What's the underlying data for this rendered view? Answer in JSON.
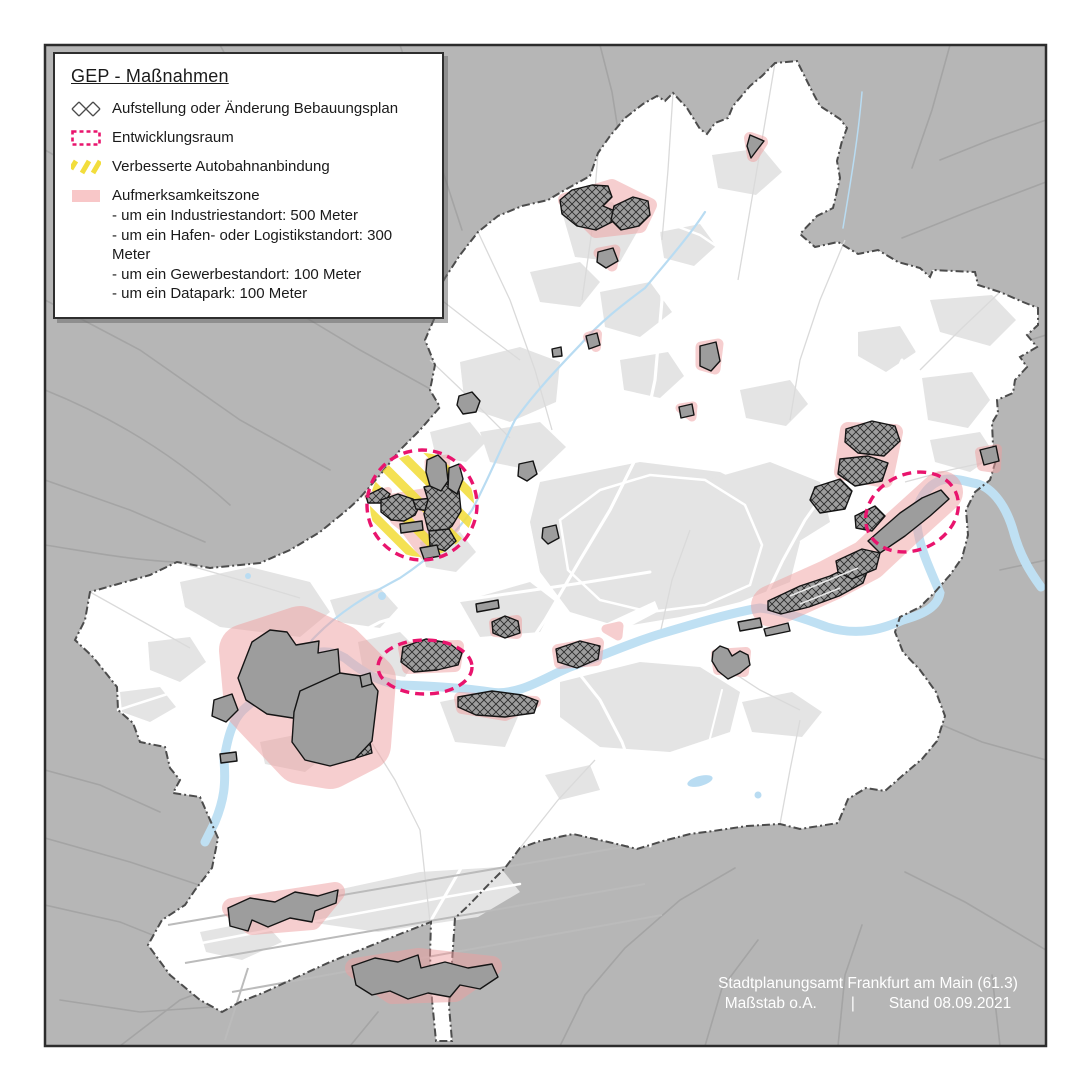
{
  "legend": {
    "title": "GEP - Maßnahmen",
    "items": [
      {
        "icon": "crosshatch-swatch",
        "label": "Aufstellung oder Änderung Bebauungsplan"
      },
      {
        "icon": "dashed-rect-swatch",
        "label": "Entwicklungsraum"
      },
      {
        "icon": "yellow-stripes-swatch",
        "label": "Verbesserte Autobahnanbindung"
      },
      {
        "icon": "pink-fill-swatch",
        "label": "Aufmerksamkeitszone",
        "sublines": [
          "- um ein Industriestandort: 500 Meter",
          "- um ein Hafen- oder Logistikstandort: 300 Meter",
          "- um ein Gewerbestandort: 100 Meter",
          "- um ein Datapark: 100 Meter"
        ]
      }
    ]
  },
  "attribution": {
    "line1": "Stadtplanungsamt Frankfurt am Main (61.3)",
    "scale_label": "Maßstab o.A.",
    "separator": "|",
    "date_label": "Stand 08.09.2021"
  },
  "colors": {
    "outside_gray": "#b6b6b6",
    "outside_roads": "#a4a4a4",
    "city_fill": "#ffffff",
    "built_up": "#e4e4e4",
    "inner_roads": "#dadada",
    "river_blue": "#bfe0f3",
    "site_gray": "#9d9d9d",
    "site_outline": "#141414",
    "attention_zone_pink": "#ef9fa0",
    "development_magenta": "#e9146d",
    "autobahn_yellow": "#f2dd3c",
    "boundary_dash": "#4c4c4c",
    "frame": "#2c2c2c"
  }
}
